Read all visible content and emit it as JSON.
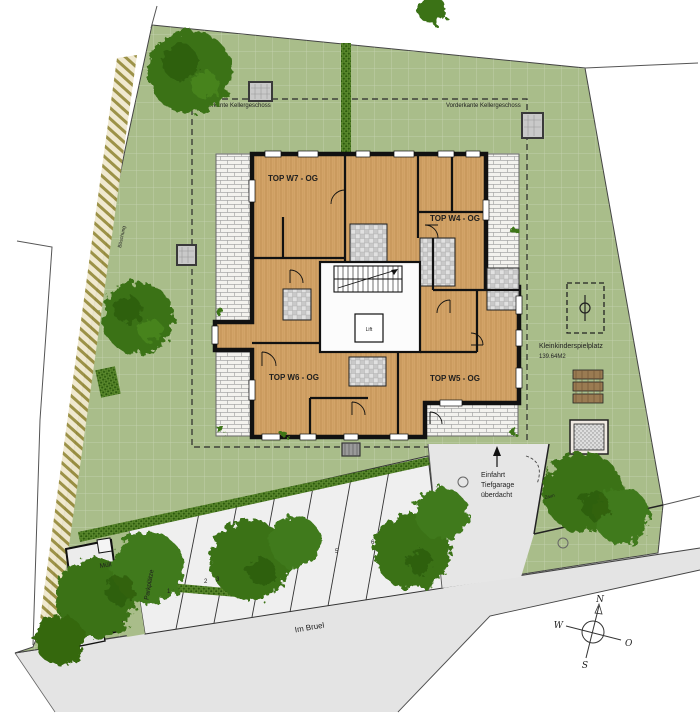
{
  "site": {
    "basement_label_left": "Vorderkante Kellergeschoss",
    "basement_label_right": "Vorderkante Kellergeschoss",
    "slope_label": "Böschung",
    "fence_label": "Zaun",
    "street_name": "Im Bruel",
    "waste_label": "Müll",
    "parking_label": "Parkplätze",
    "parking_numbers": [
      "1",
      "2",
      "3",
      "5",
      "6"
    ],
    "garage_entrance": {
      "line1": "Einfahrt",
      "line2": "Tiefgarage",
      "line3": "überdacht"
    },
    "playground": {
      "name": "Kleinkinderspielplatz",
      "area": "139.64M2"
    }
  },
  "building": {
    "apartments": [
      {
        "label": "TOP W7 - OG"
      },
      {
        "label": "TOP W4 - OG"
      },
      {
        "label": "TOP W6 - OG"
      },
      {
        "label": "TOP W5 - OG"
      }
    ],
    "lift_label": "Lift"
  },
  "compass": {
    "n": "N",
    "o": "O",
    "s": "S",
    "w": "W"
  },
  "colors": {
    "grass": "#a9bd8a",
    "hedge": "#2e5c10",
    "tree": "#3a7217",
    "street": "#e4e4e4",
    "wood_floor": "#d3a368",
    "wall": "#111111"
  }
}
